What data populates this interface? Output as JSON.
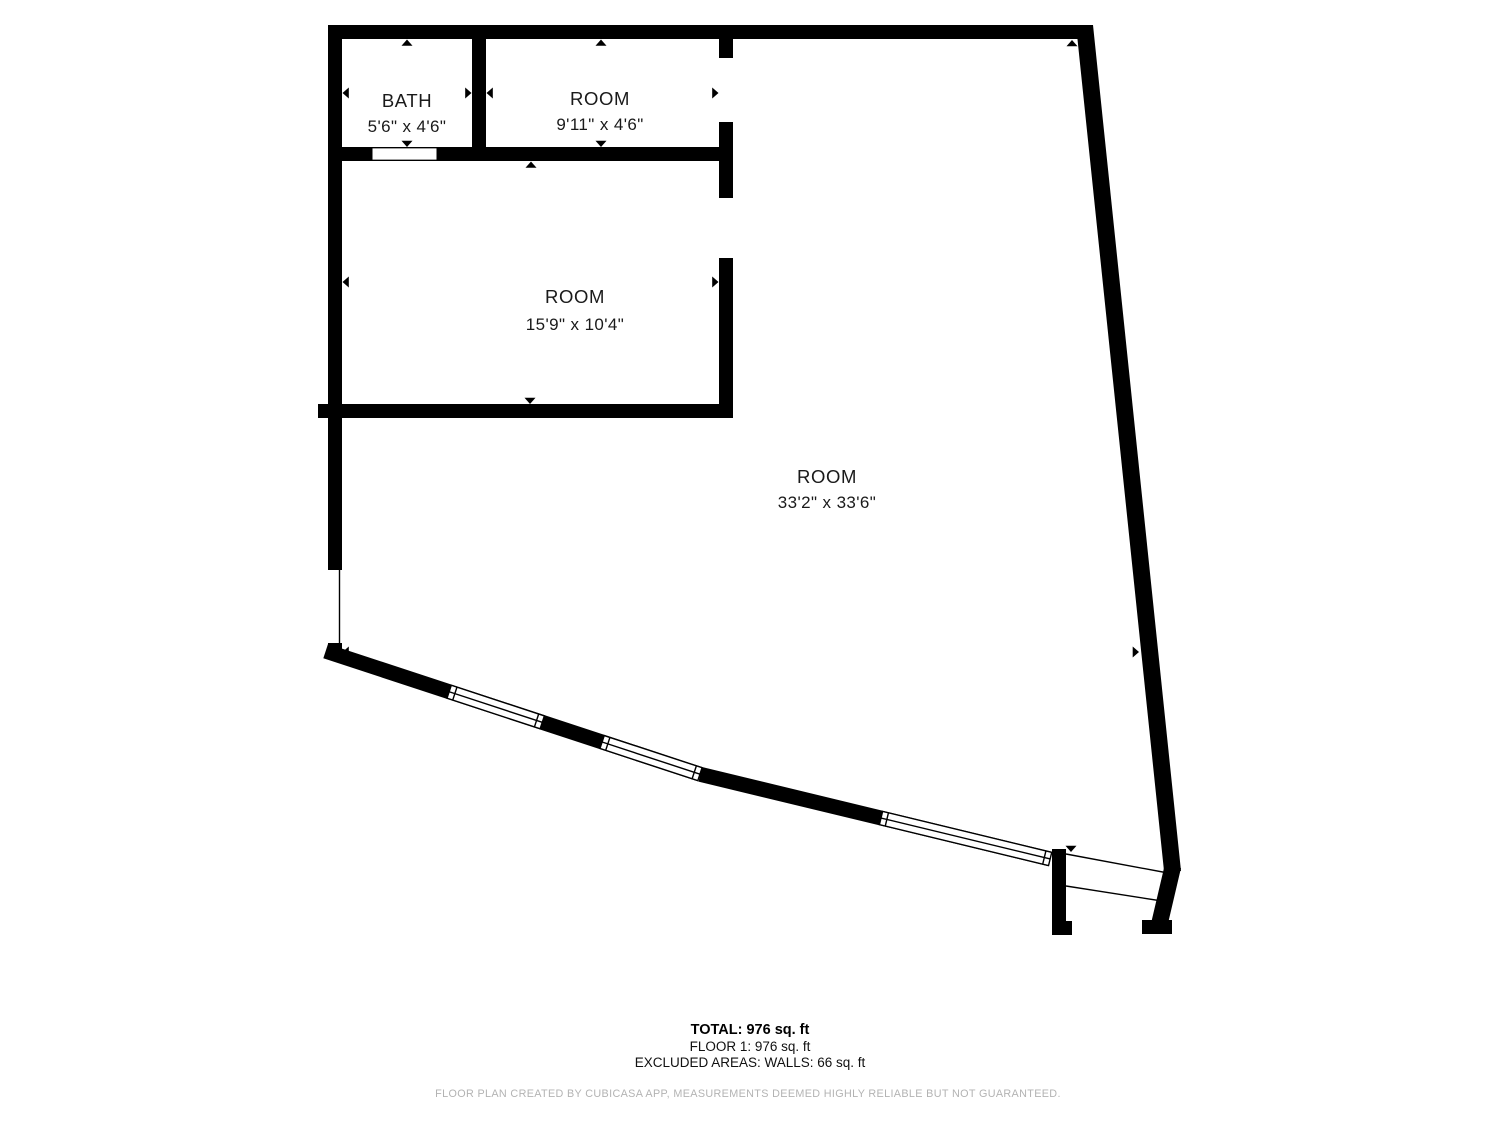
{
  "plan": {
    "wall_color": "#000000",
    "label_color": "#1a1a1a",
    "rooms": [
      {
        "name": "BATH",
        "dimensions": "5'6\" x 4'6\""
      },
      {
        "name": "ROOM",
        "dimensions": "9'11\" x 4'6\""
      },
      {
        "name": "ROOM",
        "dimensions": "15'9\" x 10'4\""
      },
      {
        "name": "ROOM",
        "dimensions": "33'2\" x 33'6\""
      }
    ]
  },
  "summary": {
    "total": "TOTAL: 976 sq. ft",
    "floor_1": "FLOOR 1: 976 sq. ft",
    "excluded_areas": "EXCLUDED AREAS: WALLS: 66 sq. ft"
  },
  "footer": {
    "disclaimer": "FLOOR PLAN CREATED BY CUBICASA APP, MEASUREMENTS DEEMED HIGHLY RELIABLE BUT NOT GUARANTEED.",
    "color": "#b3b3b3"
  }
}
